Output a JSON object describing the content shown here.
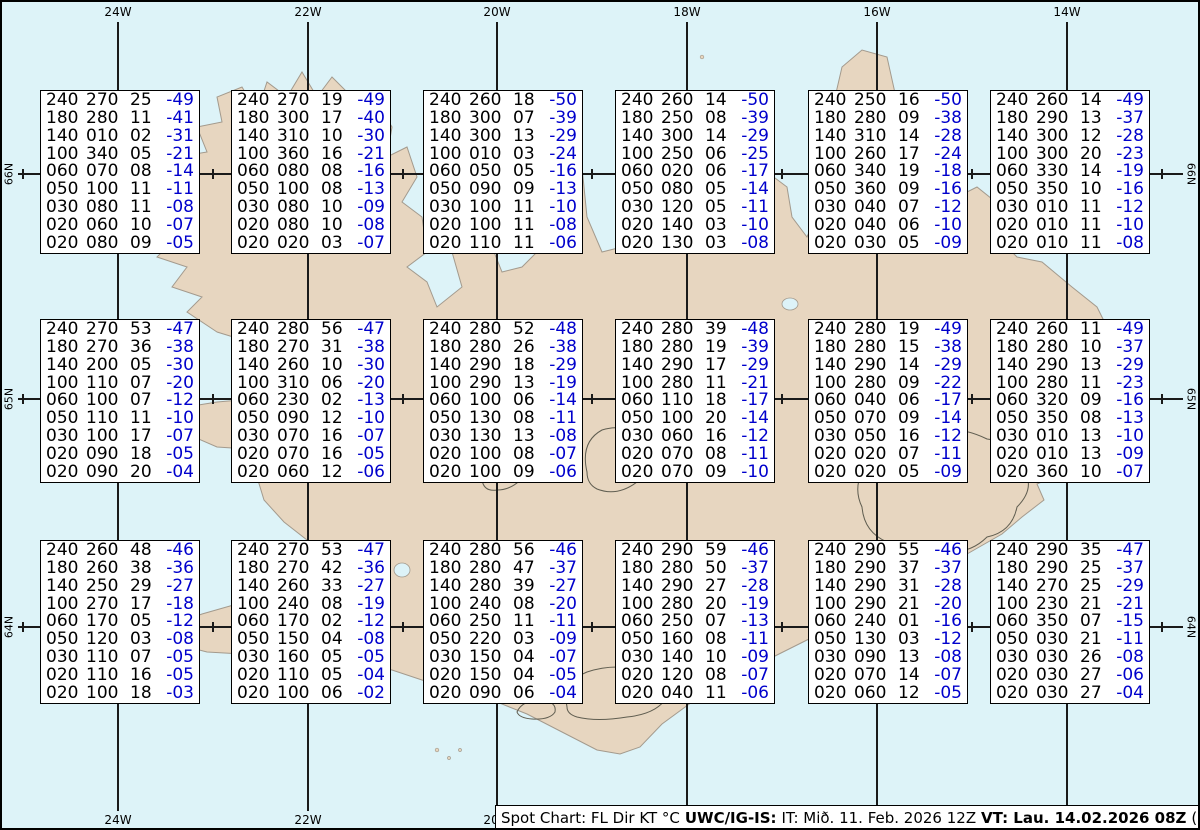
{
  "colors": {
    "ocean": "#ddf3f8",
    "land": "#e7d6c0",
    "coastline": "#a39a8d",
    "contour": "#5f5d50",
    "temp_blue": "#0000cc",
    "text_black": "#000000",
    "graticule": "#1a1a1a",
    "box_bg": "#ffffff"
  },
  "graticule": {
    "top_labels": [
      "24W",
      "22W",
      "20W",
      "18W",
      "16W",
      "14W"
    ],
    "bottom_labels": [
      "24W",
      "22W",
      "20W"
    ],
    "left_labels": [
      "66N",
      "65N",
      "64N"
    ],
    "right_labels": [
      "66N",
      "65N",
      "64N"
    ]
  },
  "status_bar": {
    "segments": [
      {
        "text": "Spot Chart: FL Dir KT °C",
        "bold": false
      },
      {
        "text": "UWC/IG-IS:",
        "bold": true
      },
      {
        "text": "IT: Mið. 11. Feb. 2026 12Z",
        "bold": false
      },
      {
        "text": "VT: Lau. 14.02.2026 08Z",
        "bold": true
      },
      {
        "text": "(+68 h)",
        "bold": false
      }
    ]
  },
  "boxes": [
    {
      "rows": [
        [
          "240",
          "270",
          "25",
          "-49"
        ],
        [
          "180",
          "280",
          "11",
          "-41"
        ],
        [
          "140",
          "010",
          "02",
          "-31"
        ],
        [
          "100",
          "340",
          "05",
          "-21"
        ],
        [
          "060",
          "070",
          "08",
          "-14"
        ],
        [
          "050",
          "100",
          "11",
          "-11"
        ],
        [
          "030",
          "080",
          "11",
          "-08"
        ],
        [
          "020",
          "060",
          "10",
          "-07"
        ],
        [
          "020",
          "080",
          "09",
          "-05"
        ]
      ]
    },
    {
      "rows": [
        [
          "240",
          "270",
          "19",
          "-49"
        ],
        [
          "180",
          "300",
          "17",
          "-40"
        ],
        [
          "140",
          "310",
          "10",
          "-30"
        ],
        [
          "100",
          "360",
          "16",
          "-21"
        ],
        [
          "060",
          "080",
          "08",
          "-16"
        ],
        [
          "050",
          "100",
          "08",
          "-13"
        ],
        [
          "030",
          "080",
          "10",
          "-09"
        ],
        [
          "020",
          "080",
          "10",
          "-08"
        ],
        [
          "020",
          "020",
          "03",
          "-07"
        ]
      ]
    },
    {
      "rows": [
        [
          "240",
          "260",
          "18",
          "-50"
        ],
        [
          "180",
          "300",
          "07",
          "-39"
        ],
        [
          "140",
          "300",
          "13",
          "-29"
        ],
        [
          "100",
          "010",
          "03",
          "-24"
        ],
        [
          "060",
          "050",
          "05",
          "-16"
        ],
        [
          "050",
          "090",
          "09",
          "-13"
        ],
        [
          "030",
          "100",
          "11",
          "-10"
        ],
        [
          "020",
          "100",
          "11",
          "-08"
        ],
        [
          "020",
          "110",
          "11",
          "-06"
        ]
      ]
    },
    {
      "rows": [
        [
          "240",
          "260",
          "14",
          "-50"
        ],
        [
          "180",
          "250",
          "08",
          "-39"
        ],
        [
          "140",
          "300",
          "14",
          "-29"
        ],
        [
          "100",
          "250",
          "06",
          "-25"
        ],
        [
          "060",
          "020",
          "06",
          "-17"
        ],
        [
          "050",
          "080",
          "05",
          "-14"
        ],
        [
          "030",
          "120",
          "05",
          "-11"
        ],
        [
          "020",
          "140",
          "03",
          "-10"
        ],
        [
          "020",
          "130",
          "03",
          "-08"
        ]
      ]
    },
    {
      "rows": [
        [
          "240",
          "250",
          "16",
          "-50"
        ],
        [
          "180",
          "280",
          "09",
          "-38"
        ],
        [
          "140",
          "310",
          "14",
          "-28"
        ],
        [
          "100",
          "260",
          "17",
          "-24"
        ],
        [
          "060",
          "340",
          "19",
          "-18"
        ],
        [
          "050",
          "360",
          "09",
          "-16"
        ],
        [
          "030",
          "040",
          "07",
          "-12"
        ],
        [
          "020",
          "040",
          "06",
          "-10"
        ],
        [
          "020",
          "030",
          "05",
          "-09"
        ]
      ]
    },
    {
      "rows": [
        [
          "240",
          "260",
          "14",
          "-49"
        ],
        [
          "180",
          "290",
          "13",
          "-37"
        ],
        [
          "140",
          "300",
          "12",
          "-28"
        ],
        [
          "100",
          "300",
          "20",
          "-23"
        ],
        [
          "060",
          "330",
          "14",
          "-19"
        ],
        [
          "050",
          "350",
          "10",
          "-16"
        ],
        [
          "030",
          "010",
          "11",
          "-12"
        ],
        [
          "020",
          "010",
          "11",
          "-10"
        ],
        [
          "020",
          "010",
          "11",
          "-08"
        ]
      ]
    },
    {
      "rows": [
        [
          "240",
          "270",
          "53",
          "-47"
        ],
        [
          "180",
          "270",
          "36",
          "-38"
        ],
        [
          "140",
          "200",
          "05",
          "-30"
        ],
        [
          "100",
          "110",
          "07",
          "-20"
        ],
        [
          "060",
          "100",
          "07",
          "-12"
        ],
        [
          "050",
          "110",
          "11",
          "-10"
        ],
        [
          "030",
          "100",
          "17",
          "-07"
        ],
        [
          "020",
          "090",
          "18",
          "-05"
        ],
        [
          "020",
          "090",
          "20",
          "-04"
        ]
      ]
    },
    {
      "rows": [
        [
          "240",
          "280",
          "56",
          "-47"
        ],
        [
          "180",
          "270",
          "31",
          "-38"
        ],
        [
          "140",
          "260",
          "10",
          "-30"
        ],
        [
          "100",
          "310",
          "06",
          "-20"
        ],
        [
          "060",
          "230",
          "02",
          "-13"
        ],
        [
          "050",
          "090",
          "12",
          "-10"
        ],
        [
          "030",
          "070",
          "16",
          "-07"
        ],
        [
          "020",
          "070",
          "16",
          "-05"
        ],
        [
          "020",
          "060",
          "12",
          "-06"
        ]
      ]
    },
    {
      "rows": [
        [
          "240",
          "280",
          "52",
          "-48"
        ],
        [
          "180",
          "280",
          "26",
          "-38"
        ],
        [
          "140",
          "290",
          "18",
          "-29"
        ],
        [
          "100",
          "290",
          "13",
          "-19"
        ],
        [
          "060",
          "100",
          "06",
          "-14"
        ],
        [
          "050",
          "130",
          "08",
          "-11"
        ],
        [
          "030",
          "130",
          "13",
          "-08"
        ],
        [
          "020",
          "100",
          "08",
          "-07"
        ],
        [
          "020",
          "100",
          "09",
          "-06"
        ]
      ]
    },
    {
      "rows": [
        [
          "240",
          "280",
          "39",
          "-48"
        ],
        [
          "180",
          "280",
          "19",
          "-39"
        ],
        [
          "140",
          "290",
          "17",
          "-29"
        ],
        [
          "100",
          "280",
          "11",
          "-21"
        ],
        [
          "060",
          "110",
          "18",
          "-17"
        ],
        [
          "050",
          "100",
          "20",
          "-14"
        ],
        [
          "030",
          "060",
          "16",
          "-12"
        ],
        [
          "020",
          "070",
          "08",
          "-11"
        ],
        [
          "020",
          "070",
          "09",
          "-10"
        ]
      ]
    },
    {
      "rows": [
        [
          "240",
          "280",
          "19",
          "-49"
        ],
        [
          "180",
          "280",
          "15",
          "-38"
        ],
        [
          "140",
          "290",
          "14",
          "-29"
        ],
        [
          "100",
          "280",
          "09",
          "-22"
        ],
        [
          "060",
          "040",
          "06",
          "-17"
        ],
        [
          "050",
          "070",
          "09",
          "-14"
        ],
        [
          "030",
          "050",
          "16",
          "-12"
        ],
        [
          "020",
          "020",
          "07",
          "-11"
        ],
        [
          "020",
          "020",
          "05",
          "-09"
        ]
      ]
    },
    {
      "rows": [
        [
          "240",
          "260",
          "11",
          "-49"
        ],
        [
          "180",
          "280",
          "10",
          "-37"
        ],
        [
          "140",
          "290",
          "13",
          "-29"
        ],
        [
          "100",
          "280",
          "11",
          "-23"
        ],
        [
          "060",
          "320",
          "09",
          "-16"
        ],
        [
          "050",
          "350",
          "08",
          "-13"
        ],
        [
          "030",
          "010",
          "13",
          "-10"
        ],
        [
          "020",
          "010",
          "13",
          "-09"
        ],
        [
          "020",
          "360",
          "10",
          "-07"
        ]
      ]
    },
    {
      "rows": [
        [
          "240",
          "260",
          "48",
          "-46"
        ],
        [
          "180",
          "260",
          "38",
          "-36"
        ],
        [
          "140",
          "250",
          "29",
          "-27"
        ],
        [
          "100",
          "270",
          "17",
          "-18"
        ],
        [
          "060",
          "170",
          "05",
          "-12"
        ],
        [
          "050",
          "120",
          "03",
          "-08"
        ],
        [
          "030",
          "110",
          "07",
          "-05"
        ],
        [
          "020",
          "110",
          "16",
          "-05"
        ],
        [
          "020",
          "100",
          "18",
          "-03"
        ]
      ]
    },
    {
      "rows": [
        [
          "240",
          "270",
          "53",
          "-47"
        ],
        [
          "180",
          "270",
          "42",
          "-36"
        ],
        [
          "140",
          "260",
          "33",
          "-27"
        ],
        [
          "100",
          "240",
          "08",
          "-19"
        ],
        [
          "060",
          "170",
          "02",
          "-12"
        ],
        [
          "050",
          "150",
          "04",
          "-08"
        ],
        [
          "030",
          "160",
          "05",
          "-05"
        ],
        [
          "020",
          "110",
          "05",
          "-04"
        ],
        [
          "020",
          "100",
          "06",
          "-02"
        ]
      ]
    },
    {
      "rows": [
        [
          "240",
          "280",
          "56",
          "-46"
        ],
        [
          "180",
          "280",
          "47",
          "-37"
        ],
        [
          "140",
          "280",
          "39",
          "-27"
        ],
        [
          "100",
          "240",
          "08",
          "-20"
        ],
        [
          "060",
          "250",
          "11",
          "-11"
        ],
        [
          "050",
          "220",
          "03",
          "-09"
        ],
        [
          "030",
          "150",
          "04",
          "-07"
        ],
        [
          "020",
          "150",
          "04",
          "-05"
        ],
        [
          "020",
          "090",
          "06",
          "-04"
        ]
      ]
    },
    {
      "rows": [
        [
          "240",
          "290",
          "59",
          "-46"
        ],
        [
          "180",
          "280",
          "50",
          "-37"
        ],
        [
          "140",
          "290",
          "27",
          "-28"
        ],
        [
          "100",
          "280",
          "20",
          "-19"
        ],
        [
          "060",
          "250",
          "07",
          "-13"
        ],
        [
          "050",
          "160",
          "08",
          "-11"
        ],
        [
          "030",
          "140",
          "10",
          "-09"
        ],
        [
          "020",
          "120",
          "08",
          "-07"
        ],
        [
          "020",
          "040",
          "11",
          "-06"
        ]
      ]
    },
    {
      "rows": [
        [
          "240",
          "290",
          "55",
          "-46"
        ],
        [
          "180",
          "290",
          "37",
          "-37"
        ],
        [
          "140",
          "290",
          "31",
          "-28"
        ],
        [
          "100",
          "290",
          "21",
          "-20"
        ],
        [
          "060",
          "240",
          "01",
          "-16"
        ],
        [
          "050",
          "130",
          "03",
          "-12"
        ],
        [
          "030",
          "090",
          "13",
          "-08"
        ],
        [
          "020",
          "070",
          "14",
          "-07"
        ],
        [
          "020",
          "060",
          "12",
          "-05"
        ]
      ]
    },
    {
      "rows": [
        [
          "240",
          "290",
          "35",
          "-47"
        ],
        [
          "180",
          "290",
          "25",
          "-37"
        ],
        [
          "140",
          "270",
          "25",
          "-29"
        ],
        [
          "100",
          "230",
          "21",
          "-21"
        ],
        [
          "060",
          "350",
          "07",
          "-15"
        ],
        [
          "050",
          "030",
          "21",
          "-11"
        ],
        [
          "030",
          "030",
          "26",
          "-08"
        ],
        [
          "020",
          "030",
          "27",
          "-06"
        ],
        [
          "020",
          "030",
          "27",
          "-04"
        ]
      ]
    }
  ]
}
